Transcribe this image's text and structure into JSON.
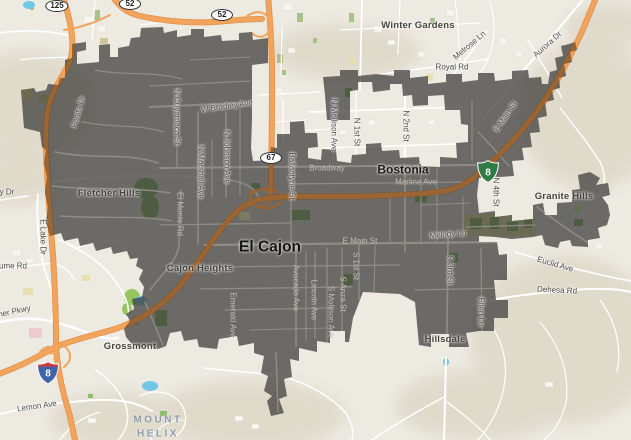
{
  "map": {
    "colors": {
      "background": "#edeae2",
      "terrain": "#ddd6c6",
      "city_overlay": "#3e3d3a",
      "motorway_orange": "#f2a45d",
      "motorway_casing": "#e2914a",
      "motorway_under_overlay": "#9b6433",
      "road_white": "#ffffff",
      "road_in_city": "#8e8c85",
      "park_green": "#a9c18c",
      "park_in_city": "#4e5c41",
      "water_blue": "#72c7e7",
      "interstate_blue": "#3d63a8",
      "interstate_red": "#cb3a3f",
      "business_green": "#2f7a45"
    },
    "shields": [
      {
        "type": "oval",
        "text": "125",
        "x": 57,
        "y": 6
      },
      {
        "type": "oval",
        "text": "52",
        "x": 130,
        "y": 4
      },
      {
        "type": "oval",
        "text": "52",
        "x": 222,
        "y": 15
      },
      {
        "type": "oval",
        "text": "67",
        "x": 271,
        "y": 158
      },
      {
        "type": "interstate",
        "text": "8",
        "x": 37,
        "y": 361
      },
      {
        "type": "business",
        "text": "8",
        "x": 477,
        "y": 160
      }
    ],
    "labels": [
      {
        "text": "Winter Gardens",
        "x": 418,
        "y": 26,
        "rot": 0,
        "style": "place"
      },
      {
        "text": "Melrose Ln",
        "x": 470,
        "y": 46,
        "rot": -40,
        "style": "street"
      },
      {
        "text": "Royal Rd",
        "x": 452,
        "y": 68,
        "rot": 0,
        "style": "street"
      },
      {
        "text": "Aurora Dr",
        "x": 548,
        "y": 45,
        "rot": -42,
        "style": "street"
      },
      {
        "text": "Fanita Dr",
        "x": 79,
        "y": 112,
        "rot": -75,
        "style": "street"
      },
      {
        "text": "W Bradley Ave",
        "x": 227,
        "y": 107,
        "rot": -8,
        "style": "street"
      },
      {
        "text": "N Cuyamaca St",
        "x": 176,
        "y": 117,
        "rot": 90,
        "style": "street"
      },
      {
        "text": "N Marshall Ave",
        "x": 200,
        "y": 172,
        "rot": 90,
        "style": "street"
      },
      {
        "text": "N Johnson Ave",
        "x": 226,
        "y": 157,
        "rot": 90,
        "style": "street"
      },
      {
        "text": "Ballantyne St",
        "x": 291,
        "y": 176,
        "rot": 90,
        "style": "street"
      },
      {
        "text": "N Mollison Ave",
        "x": 333,
        "y": 125,
        "rot": 90,
        "style": "street"
      },
      {
        "text": "N 1st St",
        "x": 356,
        "y": 132,
        "rot": 90,
        "style": "street"
      },
      {
        "text": "N 2nd St",
        "x": 405,
        "y": 126,
        "rot": 90,
        "style": "street"
      },
      {
        "text": "N 4th St",
        "x": 495,
        "y": 192,
        "rot": 90,
        "style": "street"
      },
      {
        "text": "Broadway",
        "x": 327,
        "y": 169,
        "rot": 0,
        "style": "street-light"
      },
      {
        "text": "Bostonia",
        "x": 403,
        "y": 170,
        "rot": 0,
        "style": "city"
      },
      {
        "text": "Marline Ave",
        "x": 416,
        "y": 183,
        "rot": 0,
        "style": "street-light"
      },
      {
        "text": "E Main St",
        "x": 506,
        "y": 117,
        "rot": -55,
        "style": "street"
      },
      {
        "text": "Granite Hills",
        "x": 564,
        "y": 197,
        "rot": 0,
        "style": "place"
      },
      {
        "text": "E Main St",
        "x": 360,
        "y": 242,
        "rot": 0,
        "style": "street-light"
      },
      {
        "text": "Melody Ln",
        "x": 448,
        "y": 235,
        "rot": -5,
        "style": "street"
      },
      {
        "text": "El Cajon",
        "x": 270,
        "y": 247,
        "rot": 0,
        "style": "city-big"
      },
      {
        "text": "Cajon Heights",
        "x": 200,
        "y": 269,
        "rot": 0,
        "style": "place"
      },
      {
        "text": "Fletcher Hills",
        "x": 109,
        "y": 194,
        "rot": 0,
        "style": "place"
      },
      {
        "text": "El Monte Rd",
        "x": 179,
        "y": 214,
        "rot": 90,
        "style": "street-light"
      },
      {
        "text": "Emerald Ave",
        "x": 232,
        "y": 315,
        "rot": 90,
        "style": "street-light"
      },
      {
        "text": "Avocado Ave",
        "x": 295,
        "y": 288,
        "rot": 90,
        "style": "street-light"
      },
      {
        "text": "Lincoln Ave",
        "x": 313,
        "y": 300,
        "rot": 90,
        "style": "street-light"
      },
      {
        "text": "S Mollison Ave",
        "x": 330,
        "y": 312,
        "rot": 90,
        "style": "street-light"
      },
      {
        "text": "S Anza St",
        "x": 342,
        "y": 294,
        "rot": 90,
        "style": "street-light"
      },
      {
        "text": "S 1st St",
        "x": 355,
        "y": 266,
        "rot": 90,
        "style": "street-light"
      },
      {
        "text": "S 3rd St",
        "x": 449,
        "y": 270,
        "rot": 90,
        "style": "street"
      },
      {
        "text": "Ellen Ln",
        "x": 480,
        "y": 312,
        "rot": 90,
        "style": "street"
      },
      {
        "text": "Hillsdale",
        "x": 445,
        "y": 340,
        "rot": 0,
        "style": "place"
      },
      {
        "text": "Euclid Ave",
        "x": 555,
        "y": 265,
        "rot": 16,
        "style": "street"
      },
      {
        "text": "Dehesa Rd",
        "x": 557,
        "y": 291,
        "rot": 3,
        "style": "street"
      },
      {
        "text": "Grossmont",
        "x": 130,
        "y": 347,
        "rot": 0,
        "style": "place"
      },
      {
        "text": "Lemon Ave",
        "x": 37,
        "y": 407,
        "rot": -8,
        "style": "street"
      },
      {
        "text": "Fletcher Pkwy",
        "x": 6,
        "y": 314,
        "rot": -12,
        "style": "street"
      },
      {
        "text": "E Lake Dr",
        "x": 42,
        "y": 237,
        "rot": 90,
        "style": "street"
      },
      {
        "text": "y Dr",
        "x": 7,
        "y": 193,
        "rot": 0,
        "style": "street"
      },
      {
        "text": "ume Rd",
        "x": 13,
        "y": 267,
        "rot": 0,
        "style": "street"
      },
      {
        "text": "MOUNT HELIX",
        "x": 158,
        "y": 427,
        "rot": 0,
        "style": "mount"
      }
    ]
  }
}
